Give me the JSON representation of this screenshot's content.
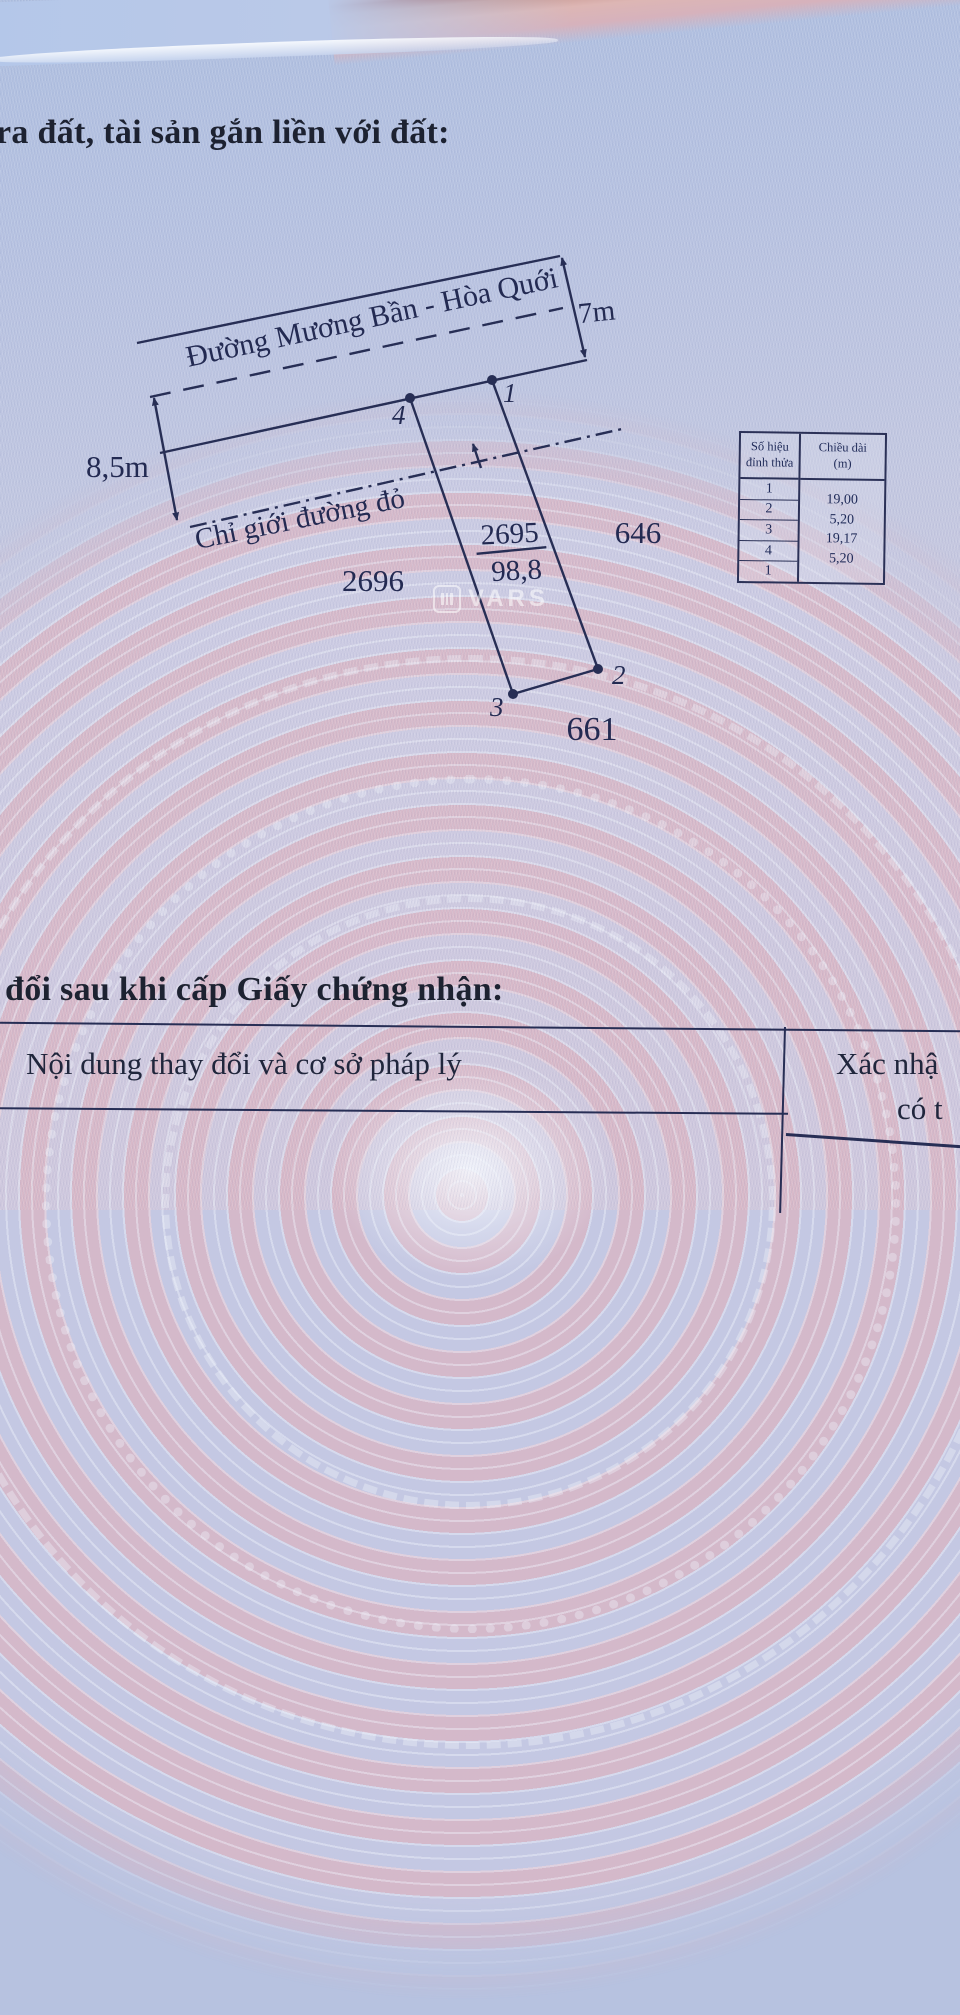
{
  "document": {
    "section_heading_top": "ra đất, tài sản gắn liền với đất:",
    "section_heading_bottom": "đổi sau khi cấp Giấy chứng nhận:"
  },
  "sketch": {
    "road_name": "Đường Mương Bần - Hòa Quới",
    "road_width": "7m",
    "setback_width": "8,5m",
    "red_boundary_label": "Chỉ giới đường đỏ",
    "parcel": {
      "number": "2695",
      "area": "98,8"
    },
    "neighbors": {
      "west": "2696",
      "east": "646",
      "south": "661"
    },
    "vertices": {
      "v1": "1",
      "v2": "2",
      "v3": "3",
      "v4": "4"
    }
  },
  "vertex_table": {
    "col1_header_line1": "Số hiệu",
    "col1_header_line2": "đỉnh thửa",
    "col2_header_line1": "Chiều dài",
    "col2_header_line2": "(m)",
    "rows": [
      "1",
      "2",
      "3",
      "4",
      "1"
    ],
    "lengths": [
      "19,00",
      "5,20",
      "19,17",
      "5,20"
    ]
  },
  "changes_table": {
    "col1_header": "Nội dung thay đổi và cơ sở pháp lý",
    "col2_header_line1": "Xác nhậ",
    "col2_header_line2": "có t"
  },
  "watermark": {
    "brand": "VARS"
  },
  "colors": {
    "ink": "#272e55",
    "heading_ink": "#1d2231",
    "paper_blue": "#b7c2e0",
    "paper_pink": "#d9b7c6",
    "band_red": "#a3574e"
  }
}
